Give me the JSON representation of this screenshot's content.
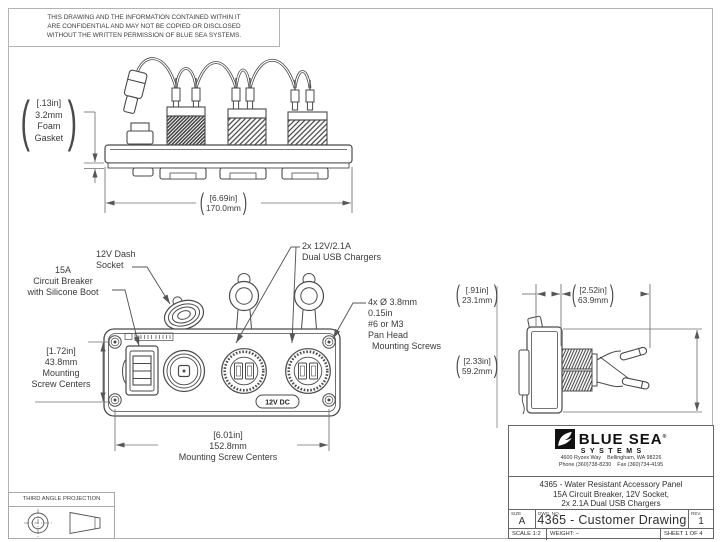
{
  "notice": {
    "lines": [
      "THIS DRAWING AND THE INFORMATION CONTAINED WITHIN IT",
      "ARE CONFIDENTIAL AND MAY NOT BE COPIED OR DISCLOSED",
      "WITHOUT THE WRITTEN PERMISSION OF BLUE SEA SYSTEMS."
    ]
  },
  "symbols": {
    "open": "(",
    "close": ")"
  },
  "callouts": {
    "foam_gasket": [
      "[.13in]",
      "3.2mm",
      "Foam",
      "Gasket"
    ],
    "overall_width": [
      "[6.69in]",
      "170.0mm"
    ],
    "dash_socket": [
      "12V Dash",
      "Socket"
    ],
    "usb_chargers": [
      "2x 12V/2.1A",
      "Dual USB Chargers"
    ],
    "circuit_breaker": [
      "15A",
      "Circuit Breaker",
      "with Silicone Boot"
    ],
    "mounting_screws": [
      "4x Ø 3.8mm",
      "0.15in",
      "#6 or M3",
      "Pan Head",
      "Mounting Screws"
    ],
    "screw_centers_vertical": [
      "[1.72in]",
      "43.8mm",
      "Mounting",
      "Screw Centers"
    ],
    "screw_centers_horizontal": [
      "[6.01in]",
      "152.8mm",
      "Mounting Screw Centers"
    ],
    "side_depth": [
      "[.91in]",
      "23.1mm"
    ],
    "side_overall": [
      "[2.52in]",
      "63.9mm"
    ],
    "side_height": [
      "[2.33in]",
      "59.2mm"
    ]
  },
  "panel": {
    "badge": "12V DC"
  },
  "projection": {
    "label": "THIRD ANGLE PROJECTION"
  },
  "title_block": {
    "brand": {
      "name_top": "BLUE SEA",
      "registered": "®",
      "name_bottom": "SYSTEMS",
      "address": "4600 Ryzex Way    Bellingham, WA 98226",
      "phone_fax": "Phone (360)738-8230    Fax (360)734-4195"
    },
    "description": [
      "4365 - Water Resistant Accessory Panel",
      "15A Circuit Breaker, 12V Socket,",
      "2x 2.1A Dual USB Chargers"
    ],
    "size_label": "SIZE",
    "size_value": "A",
    "dwg_label": "DWG. NO.",
    "dwg_value": "4365 - Customer Drawing",
    "rev_label": "REV.",
    "rev_value": "1",
    "scale": "SCALE 1:2",
    "weight": "WEIGHT: –",
    "sheet": "SHEET 1 OF 4"
  },
  "colors": {
    "line": "#4a4a4a",
    "dim_line": "#6f6f6f",
    "text": "#3a3a3a",
    "title_text": "#2e2e2e",
    "logo_black": "#111111"
  }
}
